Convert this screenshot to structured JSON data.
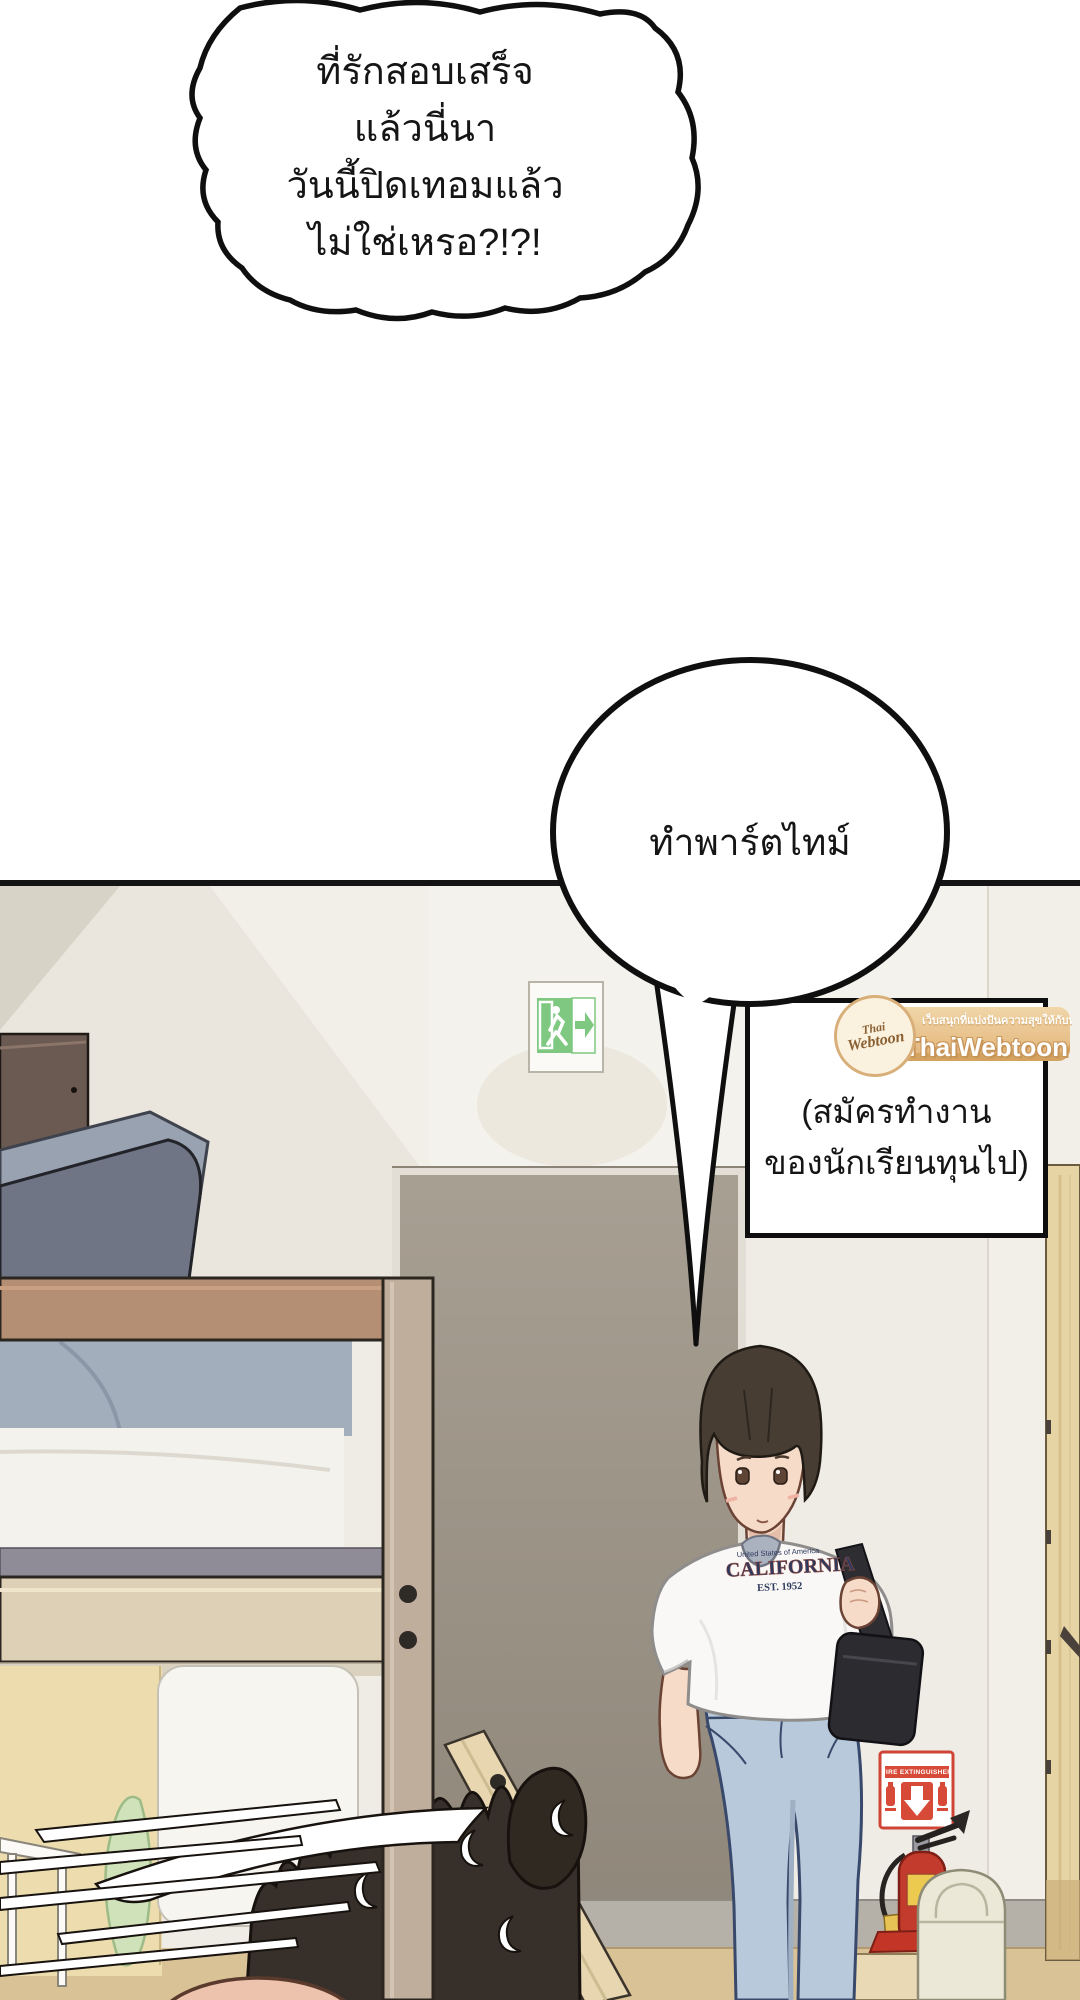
{
  "page": {
    "width": 1080,
    "height": 2000,
    "background": "#ffffff"
  },
  "speech": {
    "top_bubble": {
      "lines": [
        "ที่รักสอบเสร็จ",
        "แล้วนี่นา",
        "วันนี้ปิดเทอมแล้ว",
        "ไม่ใช่เหรอ?!?!"
      ]
    },
    "round_bubble": {
      "text": "ทำพาร์ตไทม์"
    },
    "caption_box": {
      "lines": [
        "(สมัครทำงาน",
        "ของนักเรียนทุนไป)"
      ]
    }
  },
  "watermark": {
    "logo_text_top": "Thai",
    "logo_text_bottom": "Webtoon",
    "tagline": "เว็บสนุกที่แบ่งปันความสุขให้กับทุกคน",
    "brand": "ThaiWebtoon",
    "banner_color": "#e2b277",
    "circle_color": "#faf2df",
    "text_color": "#ffffff",
    "logo_text_color": "#8a6032"
  },
  "scene": {
    "exit_sign": {
      "type": "emergency-exit-running-man",
      "green": "#7fc881"
    },
    "fire_sign": {
      "label": "FIRE EXTINGUISHER",
      "red": "#d84a38"
    },
    "tshirt_print": {
      "line1": "United States of America",
      "line2": "CALIFORNIA",
      "line3": "EST. 1952",
      "navy": "#2e3a5e"
    },
    "colors": {
      "wall": "#efece6",
      "wall_shadow": "#e5e0d5",
      "door_opening": "#a29a8d",
      "wood_door": "#e6d4a5",
      "floor": "#d9c295",
      "baseboard": "#b5b1a8",
      "bed_wood": "#b58f74",
      "bed_wood_light": "#ddd0b6",
      "pillow_dark": "#6f7584",
      "pillow_light": "#99a2b0",
      "bedding": "#a3aebc",
      "jeans": "#b7c9da",
      "hair": "#453b31",
      "skin": "#f6dbc9",
      "bag": "#2e2d31",
      "extinguisher_red": "#c23b2c",
      "bin": "#ebe8d8",
      "leaf": "#cfe2ba"
    }
  }
}
